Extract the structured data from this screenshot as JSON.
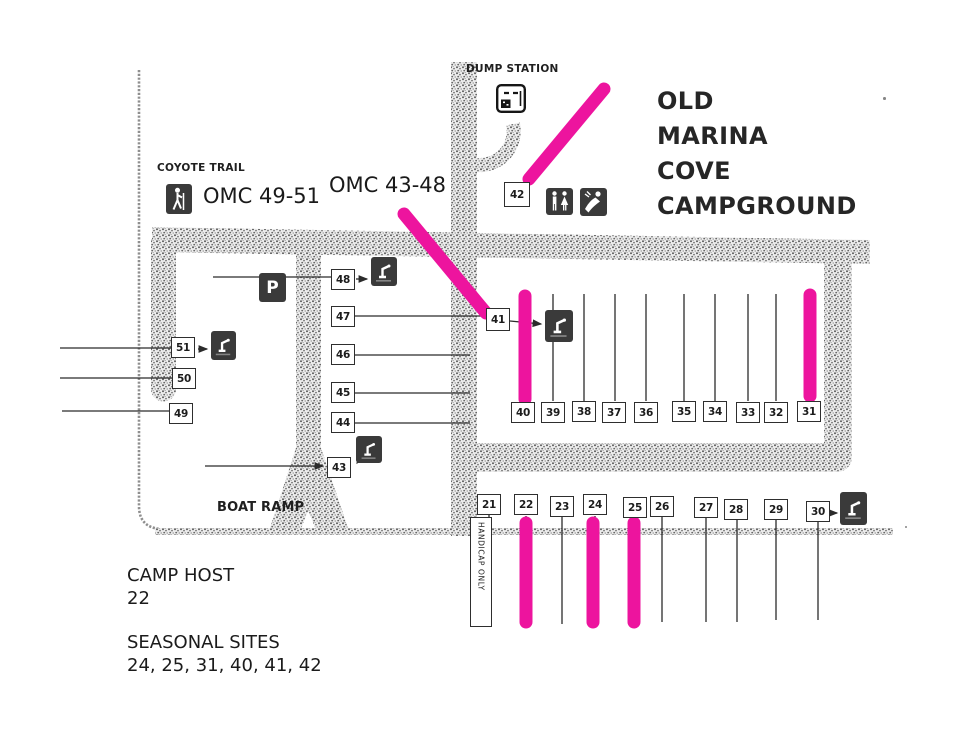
{
  "title_lines": [
    "OLD",
    "MARINA",
    "COVE",
    "CAMPGROUND"
  ],
  "labels": {
    "dump_station": "DUMP STATION",
    "coyote_trail": "COYOTE TRAIL",
    "omc_49_51": "OMC 49-51",
    "omc_43_48": "OMC 43-48",
    "boat_ramp": "BOAT RAMP",
    "handicap_only": "HANDICAP ONLY",
    "parking": "P"
  },
  "legend": {
    "camp_host_label": "CAMP HOST",
    "camp_host_value": "22",
    "seasonal_label": "SEASONAL SITES",
    "seasonal_value": "24, 25, 31, 40, 41, 42"
  },
  "sites": {
    "left_column": [
      "51",
      "50",
      "49"
    ],
    "middle_column": [
      "48",
      "47",
      "46",
      "45",
      "44",
      "43"
    ],
    "singles": [
      "42",
      "41"
    ],
    "upper_row": [
      "40",
      "39",
      "38",
      "37",
      "36",
      "35",
      "34",
      "33",
      "32",
      "31"
    ],
    "lower_row": [
      "21",
      "22",
      "23",
      "24",
      "25",
      "26",
      "27",
      "28",
      "29",
      "30"
    ]
  },
  "highlighted_sites": [
    "42",
    "41",
    "40",
    "31",
    "22",
    "24",
    "25"
  ],
  "icons": {
    "hiker-icon": "hiker on trail marker",
    "parking-icon": "parking lot P marker",
    "dump-station-icon": "RV dump station marker",
    "restroom-icon": "restroom building marker",
    "shower-icon": "shower building marker",
    "water-spigot-icon": "water spigot marker"
  },
  "colors": {
    "highlight": "#ED149E",
    "road": "#6e6e6e",
    "ink": "#1c1c1c"
  }
}
